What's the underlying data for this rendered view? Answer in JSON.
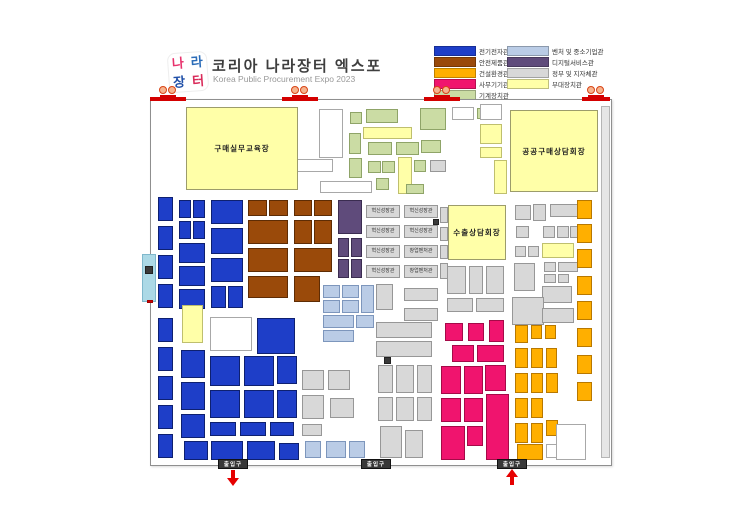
{
  "header": {
    "title": "코리아 나라장터 엑스포",
    "subtitle": "Korea Public Procurement Expo 2023",
    "logo_chars": [
      "나",
      "라",
      "장",
      "터"
    ],
    "logo_colors": [
      "#e8336d",
      "#2b6cb8",
      "#1f4fa8",
      "#d92b5a"
    ]
  },
  "legend": {
    "columns": [
      [
        {
          "label": "전기전자관",
          "c": "bl"
        },
        {
          "label": "안전제품관",
          "c": "br"
        },
        {
          "label": "건설환경관",
          "c": "or"
        },
        {
          "label": "사무기기관",
          "c": "pk"
        },
        {
          "label": "기계장치관",
          "c": "gn"
        }
      ],
      [
        {
          "label": "벤처 및 중소기업관",
          "c": "lb"
        },
        {
          "label": "디지털서비스관",
          "c": "pu"
        },
        {
          "label": "정부 및 지자체관",
          "c": "gy"
        },
        {
          "label": "부대장치관",
          "c": "yl"
        }
      ]
    ]
  },
  "colors": {
    "bl": {
      "bg": "#1e3ec8",
      "bd": "#0e2070"
    },
    "br": {
      "bg": "#9a4a0a",
      "bd": "#5e2c04"
    },
    "or": {
      "bg": "#ffaf00",
      "bd": "#b87800"
    },
    "pk": {
      "bg": "#f0146e",
      "bd": "#a50a48"
    },
    "gn": {
      "bg": "#cbdca4",
      "bd": "#8fa468"
    },
    "lb": {
      "bg": "#bacce6",
      "bd": "#7d96bc"
    },
    "pu": {
      "bg": "#5f4b7b",
      "bd": "#3a2c50"
    },
    "gy": {
      "bg": "#d8d8d8",
      "bd": "#979797"
    },
    "yl": {
      "bg": "#ffffa8",
      "bd": "#bfbf6e"
    },
    "wh": {
      "bg": "#ffffff",
      "bd": "#a8a8a8"
    },
    "dk": {
      "bg": "#3a3a3a",
      "bd": "#222222"
    },
    "cy": {
      "bg": "#acd9e6",
      "bd": "#7fb8cc"
    },
    "rb": {
      "bg": "#e6e6e6",
      "bd": "#b5b5b5"
    },
    "rd": {
      "bg": "#d40000",
      "bd": "#a00000"
    }
  },
  "map": {
    "rooms": [
      {
        "x": 186,
        "y": 107,
        "w": 112,
        "h": 83,
        "label": "구매실무교육장"
      },
      {
        "x": 510,
        "y": 110,
        "w": 88,
        "h": 82,
        "label": "공공구매상담회장"
      },
      {
        "x": 448,
        "y": 205,
        "w": 58,
        "h": 55,
        "label": "수출상담회장"
      }
    ],
    "booths": [
      [
        319,
        109,
        24,
        49,
        "wh"
      ],
      [
        350,
        112,
        12,
        12,
        "gn"
      ],
      [
        366,
        109,
        32,
        14,
        "gn"
      ],
      [
        420,
        108,
        26,
        22,
        "gn"
      ],
      [
        452,
        107,
        22,
        13,
        "wh"
      ],
      [
        477,
        108,
        14,
        11,
        "gn"
      ],
      [
        363,
        127,
        49,
        12,
        "yl"
      ],
      [
        480,
        104,
        22,
        16,
        "wh"
      ],
      [
        480,
        124,
        22,
        20,
        "yl"
      ],
      [
        480,
        147,
        22,
        11,
        "yl"
      ],
      [
        349,
        133,
        12,
        21,
        "gn"
      ],
      [
        368,
        142,
        24,
        13,
        "gn"
      ],
      [
        396,
        142,
        23,
        13,
        "gn"
      ],
      [
        421,
        140,
        20,
        13,
        "gn"
      ],
      [
        349,
        158,
        13,
        20,
        "gn"
      ],
      [
        368,
        161,
        13,
        12,
        "gn"
      ],
      [
        382,
        161,
        13,
        12,
        "gn"
      ],
      [
        398,
        157,
        14,
        37,
        "yl"
      ],
      [
        414,
        160,
        12,
        12,
        "gn"
      ],
      [
        295,
        159,
        38,
        13,
        "wh"
      ],
      [
        320,
        181,
        52,
        12,
        "wh"
      ],
      [
        376,
        178,
        13,
        12,
        "gn"
      ],
      [
        406,
        184,
        18,
        10,
        "gn"
      ],
      [
        430,
        160,
        16,
        12,
        "gy"
      ],
      [
        494,
        160,
        13,
        34,
        "yl"
      ],
      [
        158,
        197,
        15,
        24,
        "bl"
      ],
      [
        158,
        226,
        15,
        24,
        "bl"
      ],
      [
        158,
        255,
        15,
        24,
        "bl"
      ],
      [
        158,
        284,
        15,
        24,
        "bl"
      ],
      [
        179,
        200,
        12,
        18,
        "bl"
      ],
      [
        193,
        200,
        12,
        18,
        "bl"
      ],
      [
        179,
        221,
        12,
        18,
        "bl"
      ],
      [
        193,
        221,
        12,
        18,
        "bl"
      ],
      [
        179,
        243,
        26,
        20,
        "bl"
      ],
      [
        179,
        266,
        26,
        20,
        "bl"
      ],
      [
        179,
        289,
        26,
        20,
        "bl"
      ],
      [
        211,
        200,
        32,
        24,
        "bl"
      ],
      [
        211,
        228,
        32,
        26,
        "bl"
      ],
      [
        211,
        258,
        32,
        24,
        "bl"
      ],
      [
        211,
        286,
        15,
        22,
        "bl"
      ],
      [
        228,
        286,
        15,
        22,
        "bl"
      ],
      [
        248,
        200,
        19,
        16,
        "br"
      ],
      [
        269,
        200,
        19,
        16,
        "br"
      ],
      [
        248,
        220,
        40,
        24,
        "br"
      ],
      [
        248,
        248,
        40,
        24,
        "br"
      ],
      [
        248,
        276,
        40,
        22,
        "br"
      ],
      [
        294,
        200,
        18,
        16,
        "br"
      ],
      [
        314,
        200,
        18,
        16,
        "br"
      ],
      [
        294,
        220,
        18,
        24,
        "br"
      ],
      [
        314,
        220,
        18,
        24,
        "br"
      ],
      [
        294,
        248,
        38,
        24,
        "br"
      ],
      [
        294,
        276,
        26,
        26,
        "br"
      ],
      [
        338,
        200,
        24,
        34,
        "pu"
      ],
      [
        338,
        238,
        11,
        19,
        "pu"
      ],
      [
        351,
        238,
        11,
        19,
        "pu"
      ],
      [
        338,
        259,
        11,
        19,
        "pu"
      ],
      [
        351,
        259,
        11,
        19,
        "pu"
      ],
      [
        323,
        285,
        17,
        13,
        "lb"
      ],
      [
        342,
        285,
        17,
        13,
        "lb"
      ],
      [
        323,
        300,
        17,
        13,
        "lb"
      ],
      [
        342,
        300,
        17,
        13,
        "lb"
      ],
      [
        361,
        285,
        13,
        28,
        "lb"
      ],
      [
        323,
        315,
        31,
        13,
        "lb"
      ],
      [
        356,
        315,
        18,
        13,
        "lb"
      ],
      [
        323,
        330,
        31,
        12,
        "lb"
      ],
      [
        366,
        205,
        34,
        13,
        "gy",
        "혁신성장관"
      ],
      [
        366,
        225,
        34,
        13,
        "gy",
        "혁신성장관"
      ],
      [
        366,
        245,
        34,
        13,
        "gy",
        "혁신성장관"
      ],
      [
        366,
        265,
        34,
        13,
        "gy",
        "혁신성장관"
      ],
      [
        404,
        205,
        34,
        13,
        "gy",
        "혁신성장관"
      ],
      [
        404,
        225,
        34,
        13,
        "gy",
        "혁신성장관"
      ],
      [
        404,
        245,
        34,
        13,
        "gy",
        "창업벤처관"
      ],
      [
        404,
        265,
        34,
        13,
        "gy",
        "창업벤처관"
      ],
      [
        404,
        288,
        34,
        13,
        "gy"
      ],
      [
        404,
        308,
        34,
        13,
        "gy"
      ],
      [
        376,
        284,
        17,
        26,
        "gy"
      ],
      [
        440,
        207,
        8,
        16,
        "gy"
      ],
      [
        440,
        227,
        8,
        14,
        "gy"
      ],
      [
        440,
        245,
        8,
        14,
        "gy"
      ],
      [
        440,
        263,
        8,
        16,
        "gy"
      ],
      [
        433,
        219,
        6,
        6,
        "dk"
      ],
      [
        447,
        266,
        19,
        28,
        "gy"
      ],
      [
        469,
        266,
        14,
        28,
        "gy"
      ],
      [
        486,
        266,
        18,
        28,
        "gy"
      ],
      [
        447,
        298,
        26,
        14,
        "gy"
      ],
      [
        476,
        298,
        28,
        14,
        "gy"
      ],
      [
        515,
        205,
        16,
        15,
        "gy"
      ],
      [
        533,
        204,
        13,
        17,
        "gy"
      ],
      [
        550,
        204,
        30,
        13,
        "gy"
      ],
      [
        516,
        226,
        13,
        12,
        "gy"
      ],
      [
        543,
        226,
        12,
        12,
        "gy"
      ],
      [
        557,
        226,
        12,
        12,
        "gy"
      ],
      [
        570,
        226,
        11,
        12,
        "gy"
      ],
      [
        515,
        246,
        11,
        11,
        "gy"
      ],
      [
        528,
        246,
        11,
        11,
        "gy"
      ],
      [
        542,
        243,
        32,
        15,
        "yl"
      ],
      [
        514,
        263,
        21,
        28,
        "gy"
      ],
      [
        544,
        262,
        12,
        10,
        "gy"
      ],
      [
        558,
        262,
        20,
        10,
        "gy"
      ],
      [
        544,
        274,
        12,
        9,
        "gy"
      ],
      [
        558,
        274,
        11,
        9,
        "gy"
      ],
      [
        542,
        286,
        30,
        17,
        "gy"
      ],
      [
        512,
        297,
        32,
        28,
        "gy"
      ],
      [
        542,
        308,
        32,
        15,
        "gy"
      ],
      [
        577,
        200,
        15,
        19,
        "or"
      ],
      [
        577,
        224,
        15,
        19,
        "or"
      ],
      [
        577,
        249,
        15,
        19,
        "or"
      ],
      [
        577,
        276,
        15,
        19,
        "or"
      ],
      [
        577,
        301,
        15,
        19,
        "or"
      ],
      [
        577,
        328,
        15,
        19,
        "or"
      ],
      [
        577,
        355,
        15,
        19,
        "or"
      ],
      [
        577,
        382,
        15,
        19,
        "or"
      ],
      [
        376,
        322,
        56,
        16,
        "gy"
      ],
      [
        376,
        341,
        56,
        16,
        "gy"
      ],
      [
        378,
        365,
        15,
        28,
        "gy"
      ],
      [
        396,
        365,
        18,
        28,
        "gy"
      ],
      [
        417,
        365,
        15,
        28,
        "gy"
      ],
      [
        378,
        397,
        15,
        24,
        "gy"
      ],
      [
        396,
        397,
        18,
        24,
        "gy"
      ],
      [
        417,
        397,
        15,
        24,
        "gy"
      ],
      [
        380,
        426,
        22,
        32,
        "gy"
      ],
      [
        405,
        430,
        18,
        28,
        "gy"
      ],
      [
        384,
        357,
        7,
        7,
        "dk"
      ],
      [
        445,
        323,
        18,
        18,
        "pk"
      ],
      [
        468,
        323,
        16,
        18,
        "pk"
      ],
      [
        489,
        320,
        15,
        22,
        "pk"
      ],
      [
        452,
        345,
        22,
        17,
        "pk"
      ],
      [
        477,
        345,
        27,
        17,
        "pk"
      ],
      [
        441,
        366,
        20,
        28,
        "pk"
      ],
      [
        464,
        366,
        19,
        28,
        "pk"
      ],
      [
        485,
        365,
        21,
        26,
        "pk"
      ],
      [
        486,
        394,
        23,
        66,
        "pk"
      ],
      [
        441,
        398,
        20,
        24,
        "pk"
      ],
      [
        464,
        398,
        19,
        24,
        "pk"
      ],
      [
        441,
        426,
        24,
        34,
        "pk"
      ],
      [
        467,
        426,
        16,
        20,
        "pk"
      ],
      [
        515,
        325,
        13,
        18,
        "or"
      ],
      [
        531,
        325,
        11,
        14,
        "or"
      ],
      [
        545,
        325,
        11,
        14,
        "or"
      ],
      [
        515,
        348,
        13,
        20,
        "or"
      ],
      [
        531,
        348,
        12,
        20,
        "or"
      ],
      [
        546,
        348,
        11,
        20,
        "or"
      ],
      [
        515,
        373,
        13,
        20,
        "or"
      ],
      [
        531,
        373,
        12,
        20,
        "or"
      ],
      [
        546,
        373,
        12,
        20,
        "or"
      ],
      [
        515,
        398,
        13,
        20,
        "or"
      ],
      [
        531,
        398,
        12,
        20,
        "or"
      ],
      [
        515,
        423,
        13,
        20,
        "or"
      ],
      [
        531,
        423,
        12,
        20,
        "or"
      ],
      [
        546,
        420,
        12,
        16,
        "or"
      ],
      [
        517,
        444,
        26,
        16,
        "or"
      ],
      [
        546,
        444,
        14,
        14,
        "wh"
      ],
      [
        158,
        318,
        15,
        24,
        "bl"
      ],
      [
        158,
        347,
        15,
        24,
        "bl"
      ],
      [
        158,
        376,
        15,
        24,
        "bl"
      ],
      [
        158,
        405,
        15,
        24,
        "bl"
      ],
      [
        158,
        434,
        15,
        24,
        "bl"
      ],
      [
        182,
        305,
        21,
        38,
        "yl"
      ],
      [
        210,
        317,
        42,
        34,
        "wh"
      ],
      [
        257,
        318,
        38,
        36,
        "bl"
      ],
      [
        181,
        350,
        24,
        28,
        "bl"
      ],
      [
        181,
        382,
        24,
        28,
        "bl"
      ],
      [
        181,
        414,
        24,
        24,
        "bl"
      ],
      [
        210,
        356,
        30,
        30,
        "bl"
      ],
      [
        244,
        356,
        30,
        30,
        "bl"
      ],
      [
        210,
        390,
        30,
        28,
        "bl"
      ],
      [
        244,
        390,
        30,
        28,
        "bl"
      ],
      [
        277,
        356,
        20,
        28,
        "bl"
      ],
      [
        277,
        390,
        20,
        28,
        "bl"
      ],
      [
        210,
        422,
        26,
        14,
        "bl"
      ],
      [
        240,
        422,
        26,
        14,
        "bl"
      ],
      [
        270,
        422,
        24,
        14,
        "bl"
      ],
      [
        184,
        441,
        24,
        19,
        "bl"
      ],
      [
        211,
        441,
        32,
        19,
        "bl"
      ],
      [
        247,
        441,
        28,
        19,
        "bl"
      ],
      [
        279,
        443,
        20,
        17,
        "bl"
      ],
      [
        305,
        441,
        16,
        17,
        "lb"
      ],
      [
        326,
        441,
        20,
        17,
        "lb"
      ],
      [
        349,
        441,
        16,
        17,
        "lb"
      ],
      [
        302,
        370,
        22,
        20,
        "gy"
      ],
      [
        328,
        370,
        22,
        20,
        "gy"
      ],
      [
        302,
        395,
        22,
        24,
        "gy"
      ],
      [
        330,
        398,
        24,
        20,
        "gy"
      ],
      [
        302,
        424,
        20,
        12,
        "gy"
      ],
      [
        556,
        424,
        30,
        36,
        "wh"
      ],
      [
        601,
        106,
        9,
        352,
        "rb"
      ],
      [
        142,
        254,
        14,
        48,
        "cy"
      ],
      [
        145,
        266,
        8,
        8,
        "dk"
      ],
      [
        147,
        300,
        6,
        3,
        "rd"
      ]
    ],
    "top_gates": [
      {
        "x": 150,
        "w": 36
      },
      {
        "x": 282,
        "w": 36
      },
      {
        "x": 424,
        "w": 36
      },
      {
        "x": 582,
        "w": 28
      }
    ],
    "entrances_bottom": [
      {
        "label": "출입구",
        "x": 233,
        "arrow": "down"
      },
      {
        "label": "출입구",
        "x": 376,
        "arrow": "none"
      },
      {
        "label": "출입구",
        "x": 512,
        "arrow": "up"
      }
    ]
  }
}
